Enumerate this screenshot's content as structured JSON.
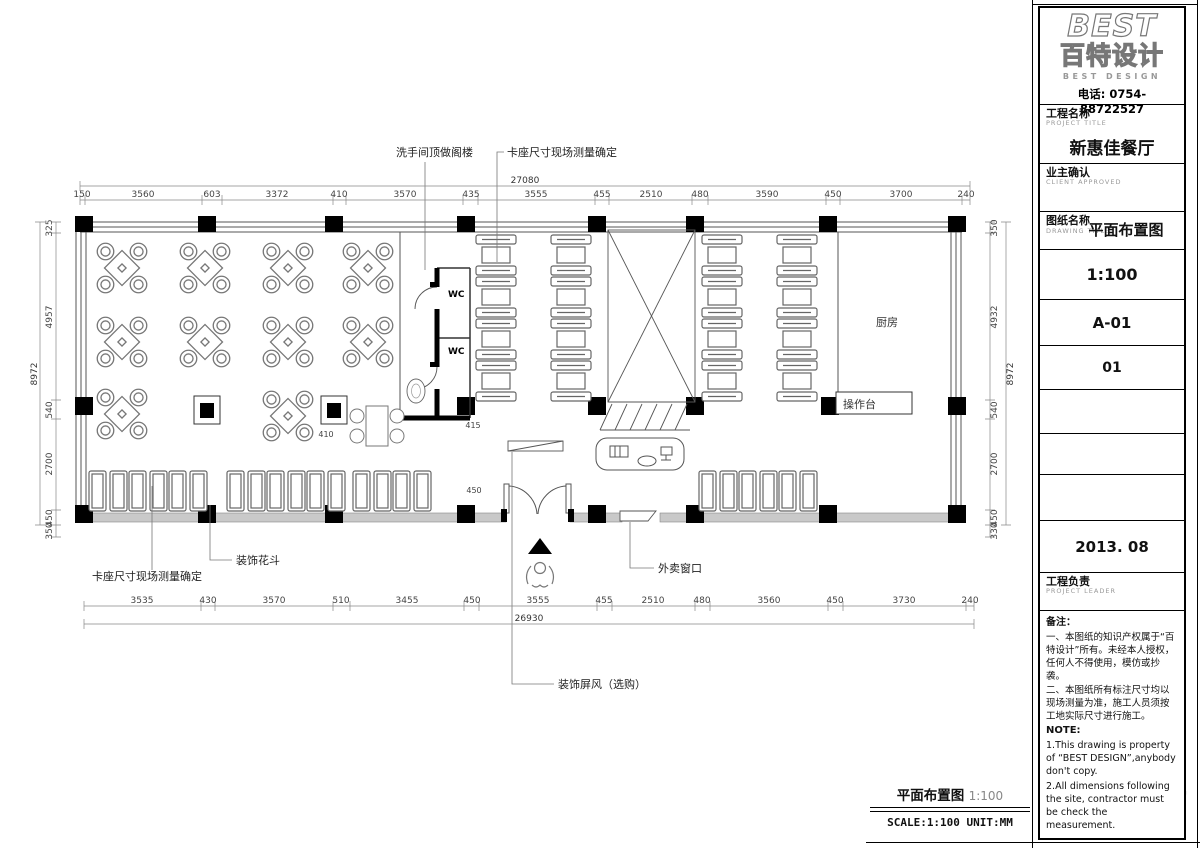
{
  "sheet": {
    "brand": {
      "logo_en": "BEST",
      "logo_cn": "百特设计",
      "logo_sub": "BEST DESIGN",
      "phone": "电话: 0754-88722527"
    },
    "fields": {
      "project_label_cn": "工程名称",
      "project_label_en": "PROJECT TITLE",
      "project_value": "新惠佳餐厅",
      "client_label_cn": "业主确认",
      "client_label_en": "CLIENT APPROVED",
      "drawing_label_cn": "图纸名称",
      "drawing_label_en": "DRAWING TITLE",
      "drawing_value": "平面布置图",
      "scale": "1:100",
      "drawing_no": "A-01",
      "page_no": "01",
      "date": "2013. 08",
      "leader_label_cn": "工程负责",
      "leader_label_en": "PROJECT LEADER"
    },
    "notes": {
      "title": "备注：",
      "cn1": "一、本图纸的知识产权属于“百特设计”所有。未经本人授权，任何人不得使用，模仿或抄袭。",
      "cn2": "二、本图纸所有标注尺寸均以现场测量为准，施工人员须按工地实际尺寸进行施工。",
      "en_title": "NOTE:",
      "en1": "1.This drawing is property of “BEST DESIGN”,anybody don't copy.",
      "en2": "2.All dimensions following the site, contractor must be check the measurement."
    },
    "footer": {
      "title": "平面布置图",
      "scale": "1:100",
      "scale_unit": "SCALE:1:100 UNIT:MM"
    },
    "watermark": "百特设计"
  },
  "plan": {
    "rooms": {
      "wc": "WC",
      "kitchen": "厨房",
      "counter": "操作台"
    },
    "callouts": {
      "toilet_loft": "洗手间顶做阁楼",
      "booth_top": "卡座尺寸现场测量确定",
      "booth_bottom": "卡座尺寸现场测量确定",
      "planter": "装饰花斗",
      "takeout": "外卖窗口",
      "screen": "装饰屏风（选购）"
    },
    "inner_dims": {
      "a": "410",
      "b": "415",
      "c": "450"
    }
  },
  "dims": {
    "top": [
      "150",
      "3560",
      "603",
      "3372",
      "410",
      "3570",
      "435",
      "3555",
      "455",
      "2510",
      "480",
      "3590",
      "450",
      "3700",
      "240"
    ],
    "top_total": "27080",
    "bottom": [
      "3535",
      "430",
      "3570",
      "510",
      "3455",
      "450",
      "3555",
      "455",
      "2510",
      "480",
      "3560",
      "450",
      "3730",
      "240"
    ],
    "bottom_total": "26930",
    "left": [
      "325",
      "4957",
      "540",
      "2700",
      "450",
      "350"
    ],
    "left_total": "8972",
    "right": [
      "350",
      "4932",
      "540",
      "2700",
      "450",
      "330"
    ],
    "right_total": "8972"
  }
}
